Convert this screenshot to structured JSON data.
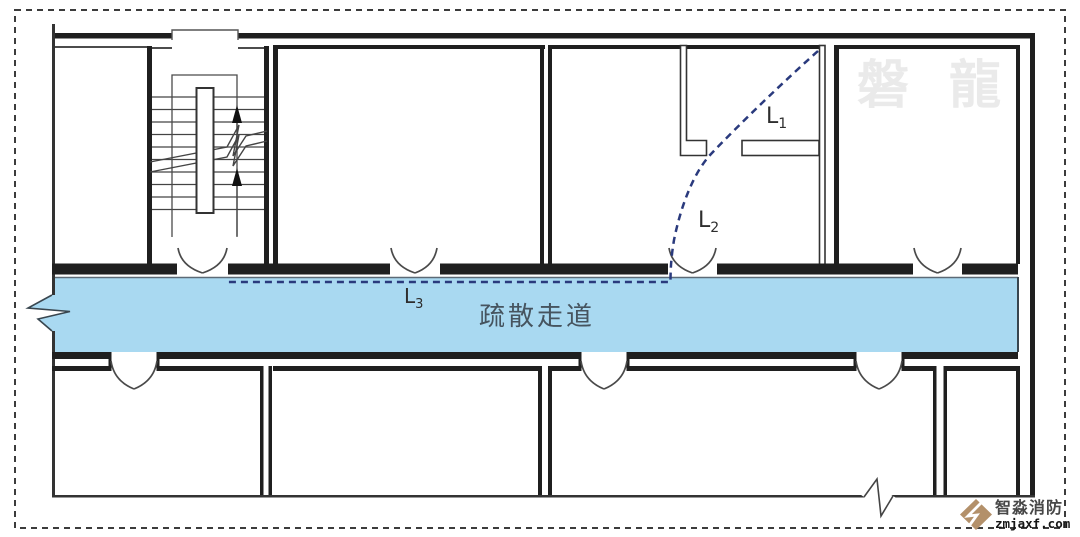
{
  "page": {
    "background": "#ffffff",
    "border_color": "#3c3c3c"
  },
  "watermark": {
    "text": "磐龍",
    "color": "#eaeaea"
  },
  "plan": {
    "wall_color": "#1f1f1f",
    "corridor": {
      "label": "疏散走道",
      "fill": "#a9d9f1",
      "label_color": "#46545f"
    },
    "evacuation_path": {
      "color": "#2a3a7d",
      "style": "dashed"
    },
    "labels": {
      "l1": {
        "base": "L",
        "sub": "1"
      },
      "l2": {
        "base": "L",
        "sub": "2"
      },
      "l3": {
        "base": "L",
        "sub": "3"
      }
    }
  },
  "logo": {
    "brand": "智淼消防",
    "site": "zmjaxf.com",
    "icon": "diamond-lightning-icon",
    "icon_color": "#b3906a",
    "brand_color": "#474747",
    "site_color": "#161616"
  }
}
